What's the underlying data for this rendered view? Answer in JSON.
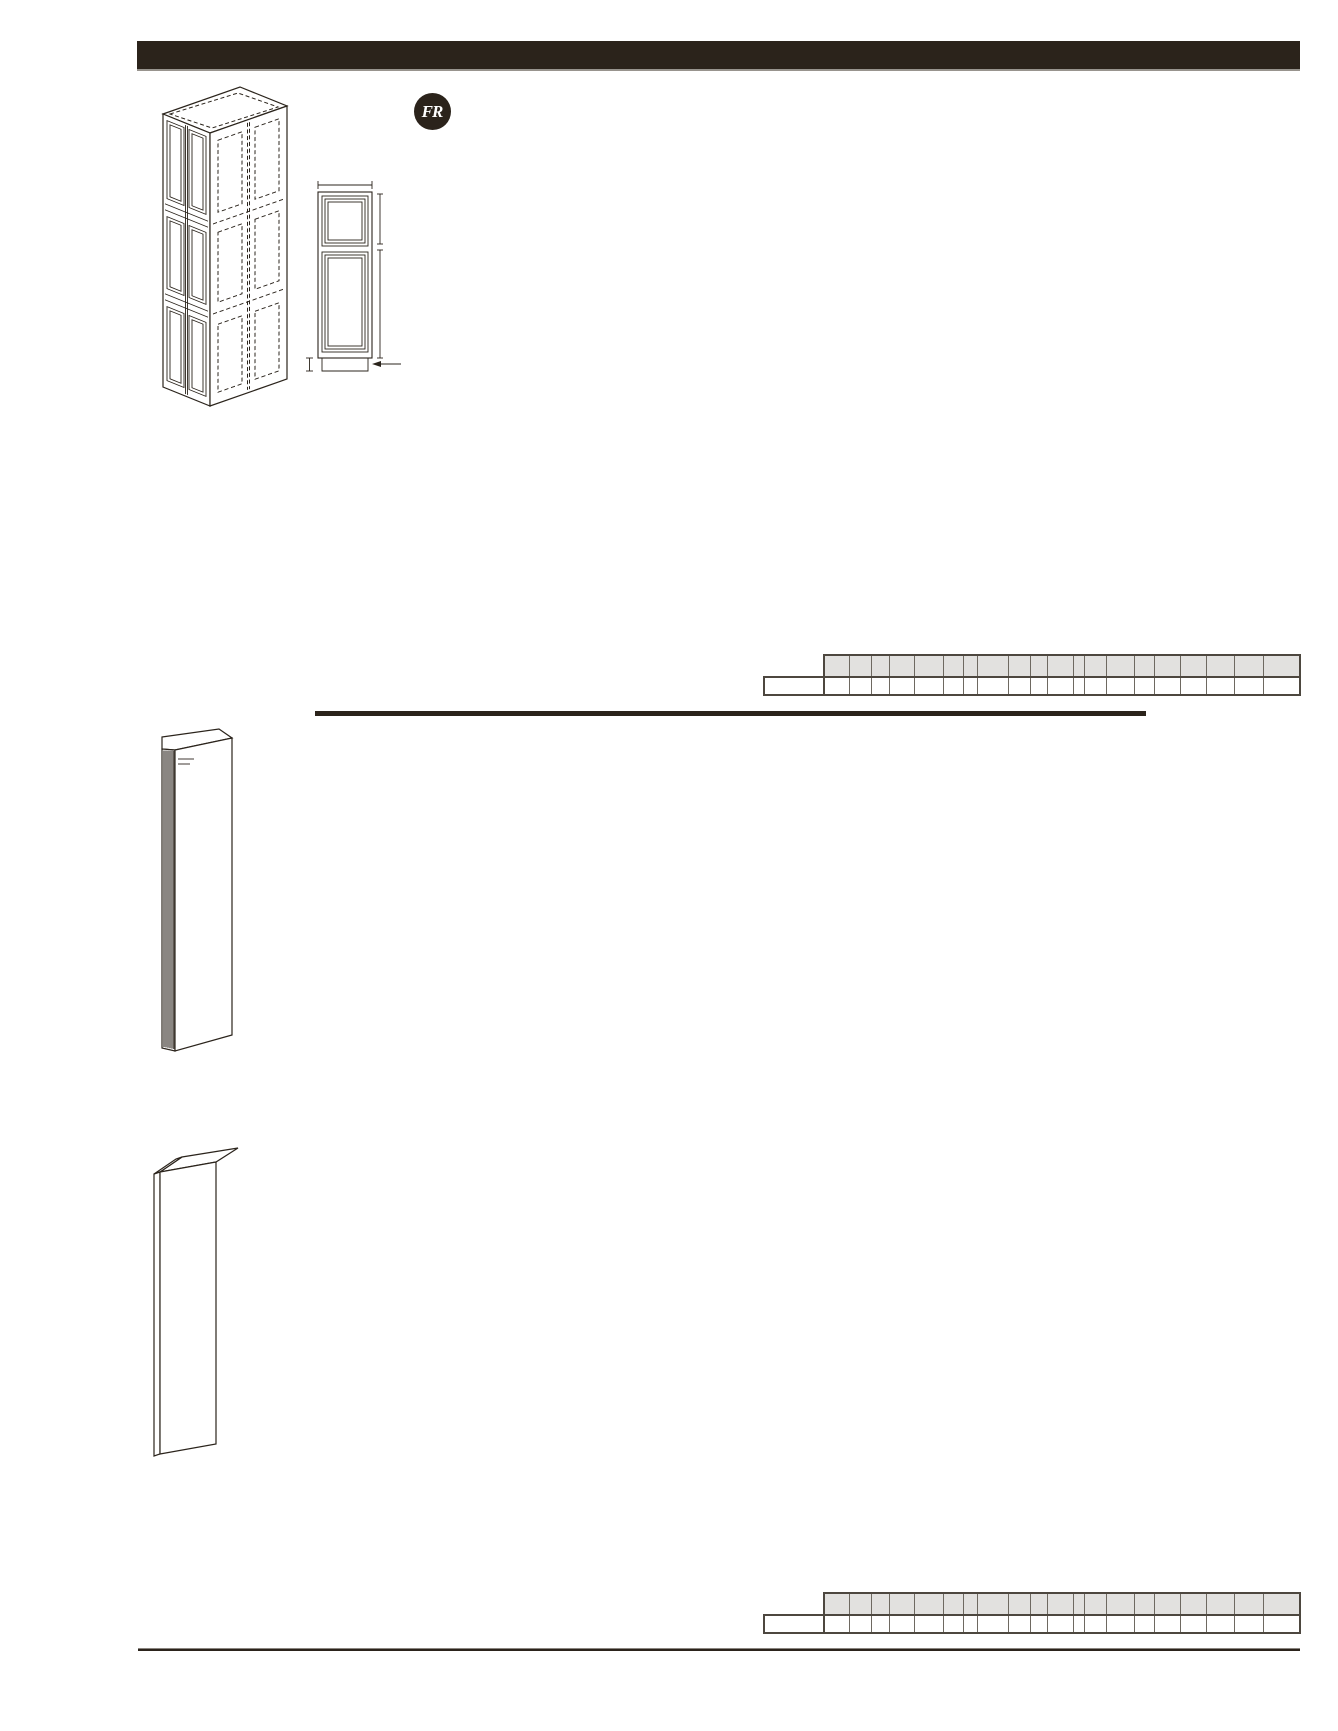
{
  "page": {
    "background": "#ffffff",
    "ink_color": "#2b231b",
    "header_bar_color": "#2b231b",
    "header_title": ""
  },
  "badge": {
    "label": "FR",
    "background": "#2b231b",
    "text_color": "#ffffff"
  },
  "figures": {
    "isometric_cabinet": "tall-cabinet-isometric-line-drawing-with-dashed-hidden-edges",
    "front_elevation": "tall-cabinet-front-elevation-with-dimension-ticks-and-toe-kick-arrow",
    "hatched_end_panel": "tall-end-panel-with-hatched-edge",
    "plain_end_panel": "tall-end-panel-plain"
  },
  "spec_tables": [
    {
      "name": "upper-spec-grid",
      "header_fill": "#e2e1df",
      "grid_line_color": "#6e6961",
      "outer_border_color": "#4d473f",
      "label_cell": "",
      "label_col_width": 60,
      "header_row_height": 22,
      "value_row_height": 20,
      "col_widths": [
        25,
        22,
        18,
        25,
        29,
        20,
        14,
        31,
        22,
        17,
        26,
        11,
        22,
        28,
        20,
        26,
        26,
        28,
        29,
        35
      ],
      "header_cells": [
        "",
        "",
        "",
        "",
        "",
        "",
        "",
        "",
        "",
        "",
        "",
        "",
        "",
        "",
        "",
        "",
        "",
        "",
        "",
        ""
      ],
      "value_cells": [
        "",
        "",
        "",
        "",
        "",
        "",
        "",
        "",
        "",
        "",
        "",
        "",
        "",
        "",
        "",
        "",
        "",
        "",
        "",
        ""
      ]
    },
    {
      "name": "lower-spec-grid",
      "header_fill": "#e2e1df",
      "grid_line_color": "#6e6961",
      "outer_border_color": "#4d473f",
      "label_cell": "",
      "label_col_width": 60,
      "header_row_height": 22,
      "value_row_height": 20,
      "col_widths": [
        25,
        22,
        18,
        25,
        29,
        20,
        14,
        31,
        22,
        17,
        26,
        11,
        22,
        28,
        20,
        26,
        26,
        28,
        29,
        35
      ],
      "header_cells": [
        "",
        "",
        "",
        "",
        "",
        "",
        "",
        "",
        "",
        "",
        "",
        "",
        "",
        "",
        "",
        "",
        "",
        "",
        "",
        ""
      ],
      "value_cells": [
        "",
        "",
        "",
        "",
        "",
        "",
        "",
        "",
        "",
        "",
        "",
        "",
        "",
        "",
        "",
        "",
        "",
        "",
        "",
        ""
      ]
    }
  ]
}
